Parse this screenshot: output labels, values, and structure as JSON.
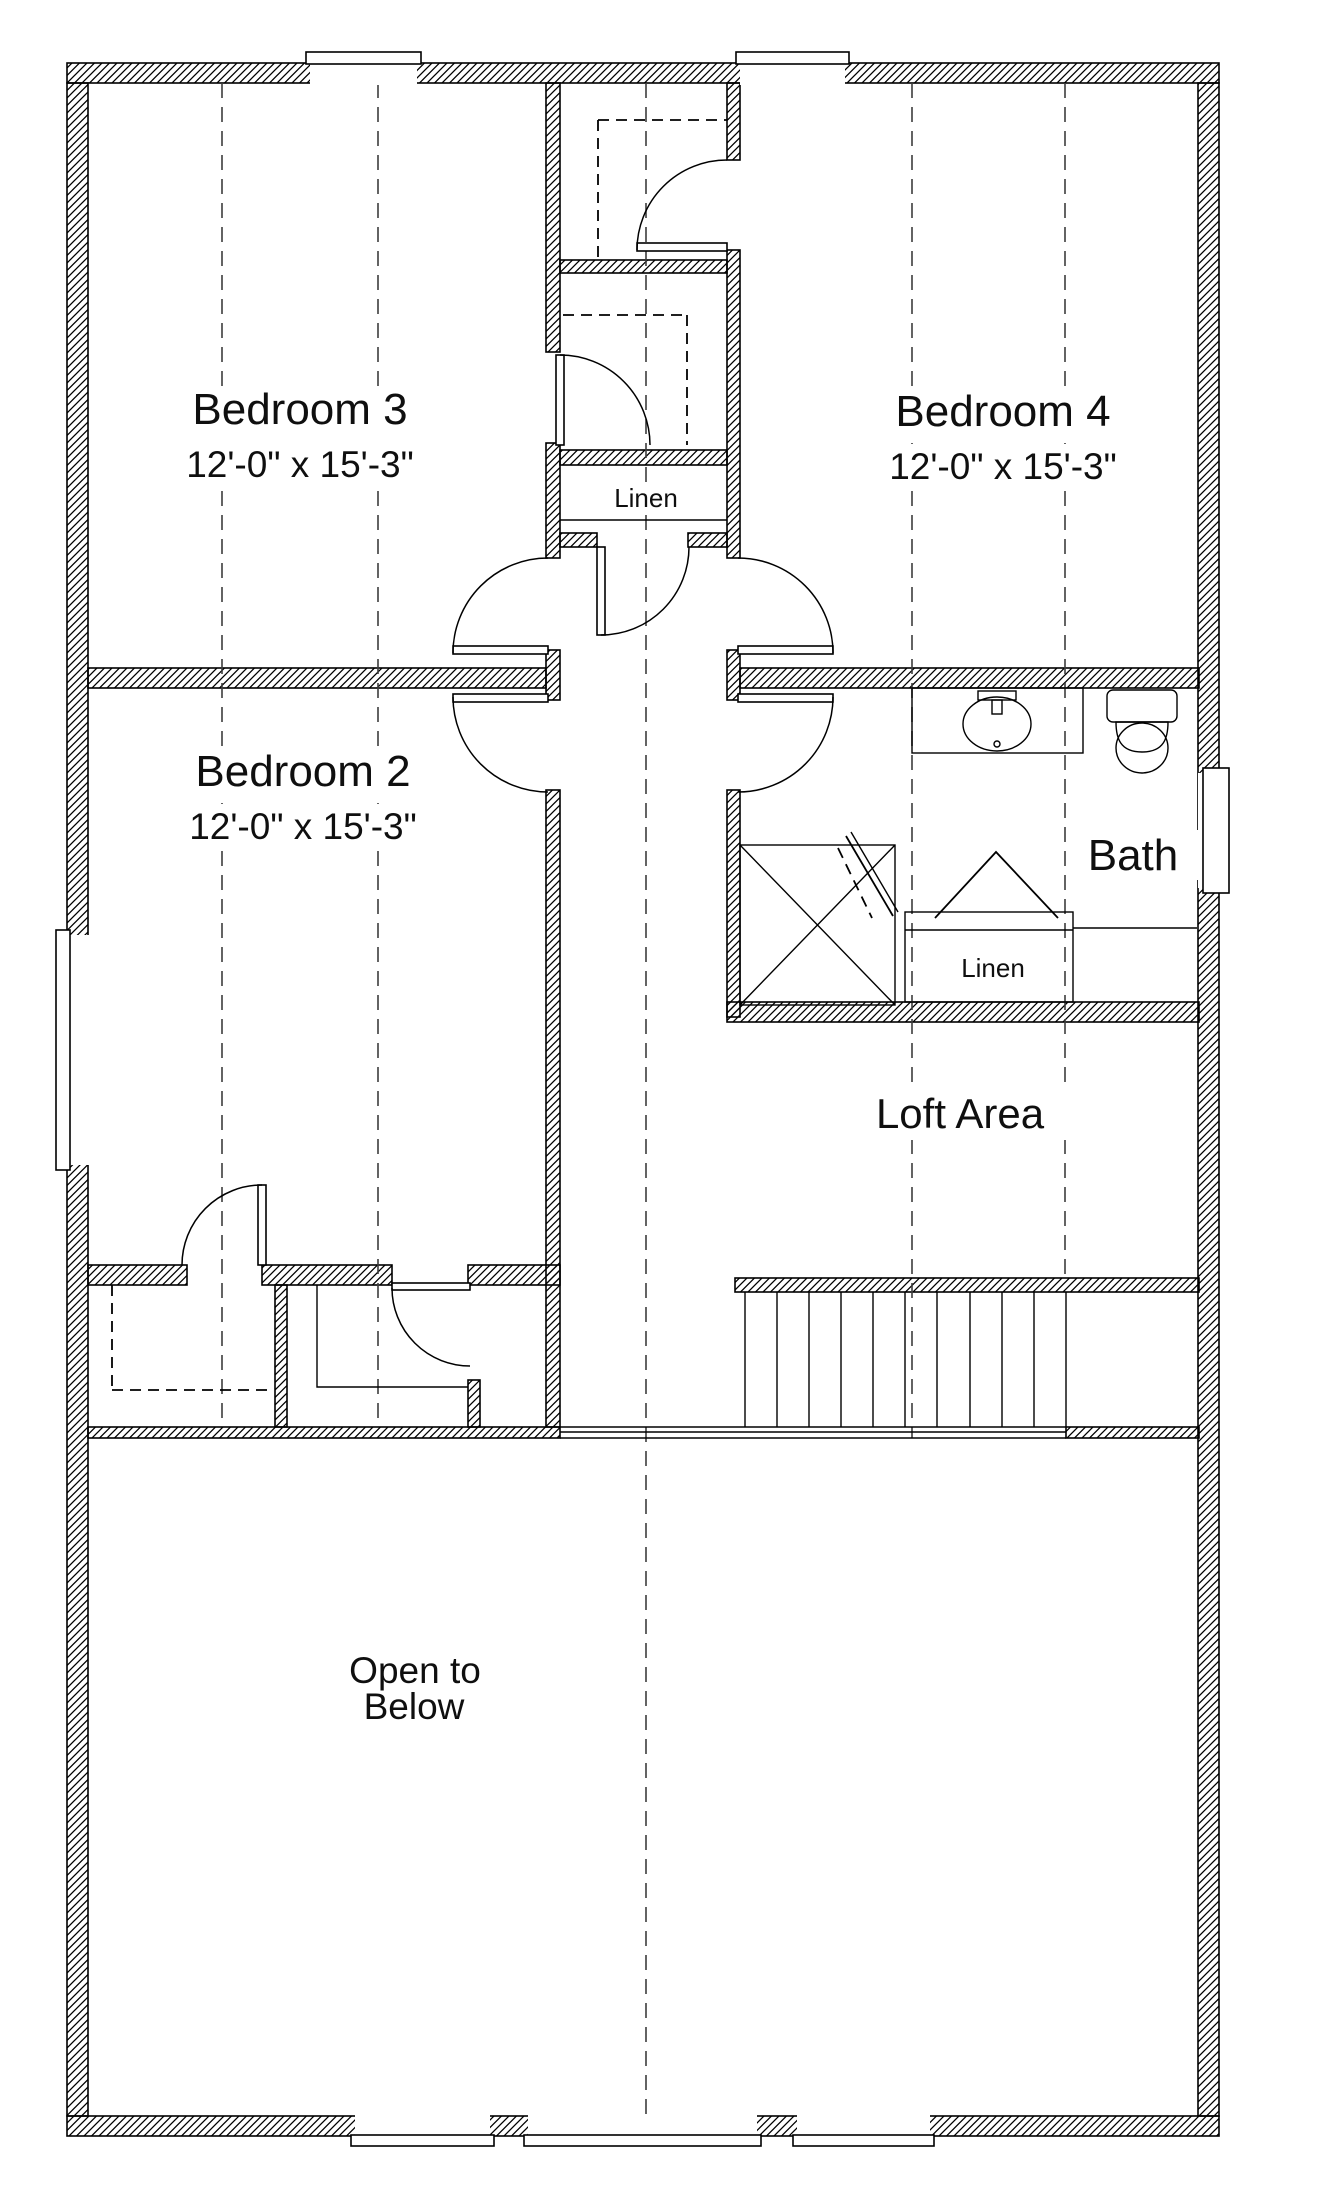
{
  "colors": {
    "background": "#ffffff",
    "line": "#000000",
    "text": "#0f0f0f",
    "ceiling_dash": "#3d3d3d"
  },
  "floor_plan": {
    "rooms": [
      {
        "id": "bedroom-3",
        "name": "Bedroom 3",
        "dimensions": "12'-0\" x 15'-3\""
      },
      {
        "id": "bedroom-4",
        "name": "Bedroom 4",
        "dimensions": "12'-0\" x 15'-3\""
      },
      {
        "id": "bedroom-2",
        "name": "Bedroom 2",
        "dimensions": "12'-0\" x 15'-3\""
      },
      {
        "id": "bath",
        "name": "Bath"
      },
      {
        "id": "loft",
        "name": "Loft Area"
      },
      {
        "id": "open-to-below",
        "name": "Open to Below",
        "line1": "Open to",
        "line2": "Below"
      }
    ],
    "closets": [
      {
        "id": "hall-linen",
        "label": "Linen"
      },
      {
        "id": "bath-linen",
        "label": "Linen"
      }
    ]
  }
}
